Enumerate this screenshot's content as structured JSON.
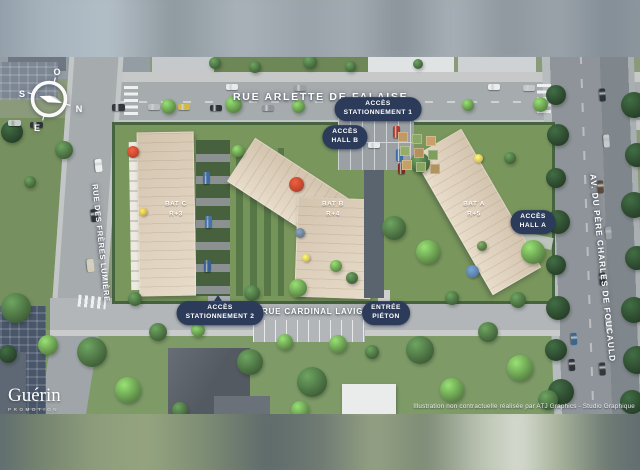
{
  "streets": {
    "top": "RUE ARLETTE DE FALAISE",
    "bottom": "RUE CARDINAL LAVIGERIE",
    "left": "RUE DES FRÈRES LUMIÈRE",
    "right": "AV. DU PÈRE CHARLES DE FOUCAULD"
  },
  "access": {
    "stationnement1": {
      "line1": "ACCÈS",
      "line2": "STATIONNEMENT 1"
    },
    "hall_b": {
      "line1": "ACCÈS",
      "line2": "HALL B"
    },
    "hall_a": {
      "line1": "ACCÈS",
      "line2": "HALL A"
    },
    "stationnement2": {
      "line1": "ACCÈS",
      "line2": "STATIONNEMENT 2"
    },
    "entree_pieton": {
      "line1": "ENTRÉE",
      "line2": "PIÉTON"
    }
  },
  "buildings": {
    "bat_c": {
      "name": "BAT C",
      "floors": "R+3"
    },
    "bat_b": {
      "name": "BAT B",
      "floors": "R+4"
    },
    "bat_a": {
      "name": "BAT A",
      "floors": "R+5"
    }
  },
  "compass": {
    "n": "N",
    "s": "S",
    "e": "E",
    "o": "O"
  },
  "branding": {
    "logo": "Guérin",
    "logo_sub": "PROMOTION"
  },
  "credit": "Illustration non contractuelle réalisée par ATJ Graphics - Studio Graphique",
  "colors": {
    "pill_bg": "#2c3b59",
    "label_text": "#ffffff",
    "roof_beige": "#e4d6c1",
    "grass_green": "#79965c",
    "asphalt": "#a6abae",
    "parasol_red": "#bd4830"
  },
  "scene": {
    "tree_palette": {
      "dark": "#2e4c30",
      "mid": "#4c7243",
      "bright": "#699c50",
      "olive": "#5c7d4a"
    },
    "trees": [
      [
        556,
        95,
        20,
        "dark"
      ],
      [
        558,
        135,
        22,
        "dark"
      ],
      [
        556,
        178,
        20,
        "dark"
      ],
      [
        558,
        222,
        24,
        "dark"
      ],
      [
        556,
        265,
        20,
        "dark"
      ],
      [
        558,
        308,
        24,
        "dark"
      ],
      [
        556,
        350,
        22,
        "dark"
      ],
      [
        561,
        392,
        26,
        "dark"
      ],
      [
        634,
        105,
        26,
        "dark"
      ],
      [
        637,
        155,
        24,
        "dark"
      ],
      [
        634,
        205,
        26,
        "dark"
      ],
      [
        637,
        258,
        24,
        "dark"
      ],
      [
        634,
        310,
        26,
        "dark"
      ],
      [
        637,
        360,
        28,
        "dark"
      ],
      [
        632,
        402,
        24,
        "dark"
      ],
      [
        168,
        106,
        15,
        "bright"
      ],
      [
        233,
        104,
        17,
        "bright"
      ],
      [
        298,
        106,
        13,
        "bright"
      ],
      [
        404,
        106,
        13,
        "bright"
      ],
      [
        468,
        105,
        12,
        "bright"
      ],
      [
        540,
        104,
        15,
        "bright"
      ],
      [
        215,
        63,
        12,
        "mid"
      ],
      [
        255,
        67,
        12,
        "mid"
      ],
      [
        310,
        62,
        14,
        "mid"
      ],
      [
        350,
        66,
        11,
        "mid"
      ],
      [
        418,
        64,
        10,
        "mid"
      ],
      [
        12,
        132,
        22,
        "dark"
      ],
      [
        64,
        150,
        18,
        "mid"
      ],
      [
        30,
        182,
        12,
        "mid"
      ],
      [
        16,
        308,
        30,
        "mid"
      ],
      [
        48,
        345,
        20,
        "bright"
      ],
      [
        8,
        354,
        18,
        "dark"
      ],
      [
        135,
        299,
        14,
        "mid"
      ],
      [
        252,
        293,
        16,
        "mid"
      ],
      [
        298,
        288,
        18,
        "bright"
      ],
      [
        352,
        278,
        12,
        "mid"
      ],
      [
        420,
        163,
        20,
        "mid"
      ],
      [
        394,
        228,
        24,
        "mid"
      ],
      [
        428,
        252,
        24,
        "bright"
      ],
      [
        452,
        298,
        14,
        "mid"
      ],
      [
        518,
        300,
        16,
        "mid"
      ],
      [
        238,
        151,
        12,
        "bright"
      ],
      [
        510,
        158,
        12,
        "mid"
      ],
      [
        336,
        266,
        12,
        "bright"
      ],
      [
        482,
        246,
        10,
        "olive"
      ],
      [
        533,
        252,
        24,
        "bright"
      ],
      [
        92,
        352,
        30,
        "mid"
      ],
      [
        128,
        390,
        26,
        "bright"
      ],
      [
        158,
        332,
        18,
        "mid"
      ],
      [
        198,
        330,
        14,
        "bright"
      ],
      [
        250,
        362,
        26,
        "mid"
      ],
      [
        285,
        342,
        16,
        "bright"
      ],
      [
        312,
        382,
        30,
        "mid"
      ],
      [
        338,
        344,
        18,
        "bright"
      ],
      [
        372,
        352,
        14,
        "mid"
      ],
      [
        420,
        350,
        28,
        "mid"
      ],
      [
        452,
        390,
        24,
        "bright"
      ],
      [
        488,
        332,
        20,
        "mid"
      ],
      [
        520,
        368,
        26,
        "bright"
      ],
      [
        548,
        400,
        20,
        "mid"
      ],
      [
        300,
        410,
        18,
        "bright"
      ],
      [
        180,
        410,
        16,
        "mid"
      ]
    ],
    "cars": [
      [
        112,
        104,
        13,
        7,
        "#32383d",
        0
      ],
      [
        148,
        104,
        12,
        6,
        "#b9bdc0",
        0
      ],
      [
        178,
        104,
        12,
        6,
        "#d2b945",
        0
      ],
      [
        210,
        105,
        12,
        6,
        "#2e3338",
        0
      ],
      [
        262,
        105,
        12,
        6,
        "#8f959a",
        0
      ],
      [
        350,
        106,
        12,
        6,
        "#33383c",
        0
      ],
      [
        226,
        84,
        12,
        6,
        "#e8eaeb",
        0
      ],
      [
        294,
        85,
        12,
        6,
        "#9aa0a4",
        0
      ],
      [
        488,
        84,
        12,
        6,
        "#eceeee",
        0
      ],
      [
        523,
        85,
        12,
        6,
        "#c3c7c9",
        0
      ],
      [
        8,
        120,
        13,
        6,
        "#caced0",
        0
      ],
      [
        30,
        122,
        13,
        6,
        "#2e343a",
        0
      ],
      [
        92,
        162,
        13,
        7,
        "#eef0f0",
        84
      ],
      [
        88,
        212,
        13,
        7,
        "#2f353a",
        84
      ],
      [
        84,
        262,
        13,
        7,
        "#d6cdb6",
        84
      ],
      [
        596,
        92,
        13,
        6,
        "#2e3338",
        86
      ],
      [
        600,
        138,
        13,
        6,
        "#c6cacc",
        86
      ],
      [
        594,
        184,
        13,
        6,
        "#5b4a3a",
        86
      ],
      [
        602,
        230,
        13,
        6,
        "#9aa0a4",
        86
      ],
      [
        596,
        276,
        13,
        6,
        "#30363b",
        86
      ],
      [
        602,
        322,
        13,
        6,
        "#c9cdcf",
        86
      ],
      [
        596,
        366,
        13,
        6,
        "#32383c",
        86
      ],
      [
        568,
        336,
        12,
        6,
        "#3a668f",
        86
      ],
      [
        566,
        362,
        12,
        6,
        "#2e3338",
        86
      ],
      [
        352,
        132,
        12,
        6,
        "#c8ccce",
        0
      ],
      [
        368,
        142,
        12,
        6,
        "#e8eaea",
        0
      ],
      [
        393,
        126,
        7,
        12,
        "#b03a2c",
        0
      ],
      [
        396,
        149,
        7,
        12,
        "#3c6ca8",
        0
      ],
      [
        398,
        163,
        7,
        11,
        "#7e2a20",
        0
      ],
      [
        203,
        172,
        7,
        12,
        "#3e6aa6",
        0
      ],
      [
        205,
        216,
        7,
        12,
        "#4273b0",
        0
      ],
      [
        204,
        260,
        7,
        12,
        "#39608f",
        0
      ]
    ],
    "parasols": [
      [
        133,
        152,
        12,
        "#c04a31"
      ],
      [
        296,
        184,
        15,
        "#bd4830"
      ],
      [
        472,
        271,
        13,
        "#5d81a8"
      ],
      [
        143,
        212,
        8,
        "#d8b94c"
      ],
      [
        306,
        258,
        8,
        "#d8c45c"
      ],
      [
        478,
        158,
        9,
        "#d8c45c"
      ],
      [
        300,
        233,
        10,
        "#6b7f95"
      ]
    ],
    "garden_patches": [
      [
        398,
        132,
        10,
        "#c09a62"
      ],
      [
        412,
        134,
        10,
        "#8aa763"
      ],
      [
        426,
        136,
        10,
        "#c7a06a"
      ],
      [
        400,
        146,
        10,
        "#97ab6b"
      ],
      [
        414,
        148,
        10,
        "#b5905d"
      ],
      [
        428,
        150,
        10,
        "#7f9e5e"
      ],
      [
        402,
        160,
        10,
        "#c2a066"
      ],
      [
        416,
        162,
        10,
        "#89a561"
      ],
      [
        430,
        164,
        10,
        "#b1935f"
      ]
    ]
  }
}
